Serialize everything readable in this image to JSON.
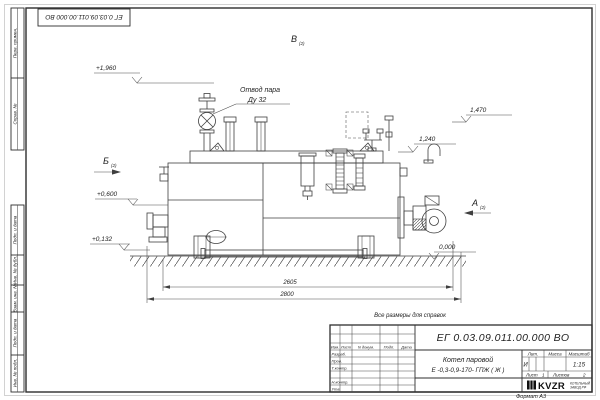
{
  "sheet": {
    "doc_number": "ЕГ 0.03.09.011.00.000  ВО",
    "ref_note": "Все размеры для справок",
    "format_note": "Формат А3"
  },
  "title_block": {
    "product_name_1": "Котел паровой",
    "product_name_2": "Е -0,3-0,9-170- ГПЖ ( Ж )",
    "cols": {
      "izm": "Изм.",
      "list": "Лист",
      "ndok": "N докум.",
      "podp": "Подп.",
      "data": "Дата"
    },
    "rows": {
      "razrab": "Разраб.",
      "prov": "Пров.",
      "tkontr": "Т.контр.",
      "nkontr": "Н.контр.",
      "utv": "Утв."
    },
    "lit_label": "Лит.",
    "lit_value": "И",
    "mass_label": "Масса",
    "scale_label": "Масштаб",
    "scale_value": "1:15",
    "sheet_label": "Лист",
    "sheet_value": "1",
    "sheets_label": "Листов",
    "sheets_value": "2",
    "logo_text": "KVZR",
    "logo_sub_1": "КОТЕЛЬНЫЙ",
    "logo_sub_2": "ЗАВОД РФ"
  },
  "margin": {
    "labels": [
      "Перв. примен.",
      "Справ. №",
      "Подп. и дата",
      "Инв. № дубл.",
      "Взам. инв. №",
      "Подп. и дата",
      "Инв. № подл."
    ]
  },
  "callouts": {
    "steam_line1": "Отвод пара",
    "steam_line2": "Ду 32",
    "view_a": "А",
    "view_b": "Б",
    "view_v": "В",
    "view_suffix": "(2)",
    "elev_plus1960": "+1,960",
    "elev_plus0600": "+0,600",
    "elev_plus0132": "+0,132",
    "elev_1470": "1,470",
    "elev_1240": "1,240",
    "elev_0000": "0,000",
    "dim_2605": "2605",
    "dim_2800": "2800"
  },
  "colors": {
    "line": "#3f3f3f",
    "frame": "#2e2e2e",
    "paper": "#ffffff",
    "text": "#222222"
  }
}
